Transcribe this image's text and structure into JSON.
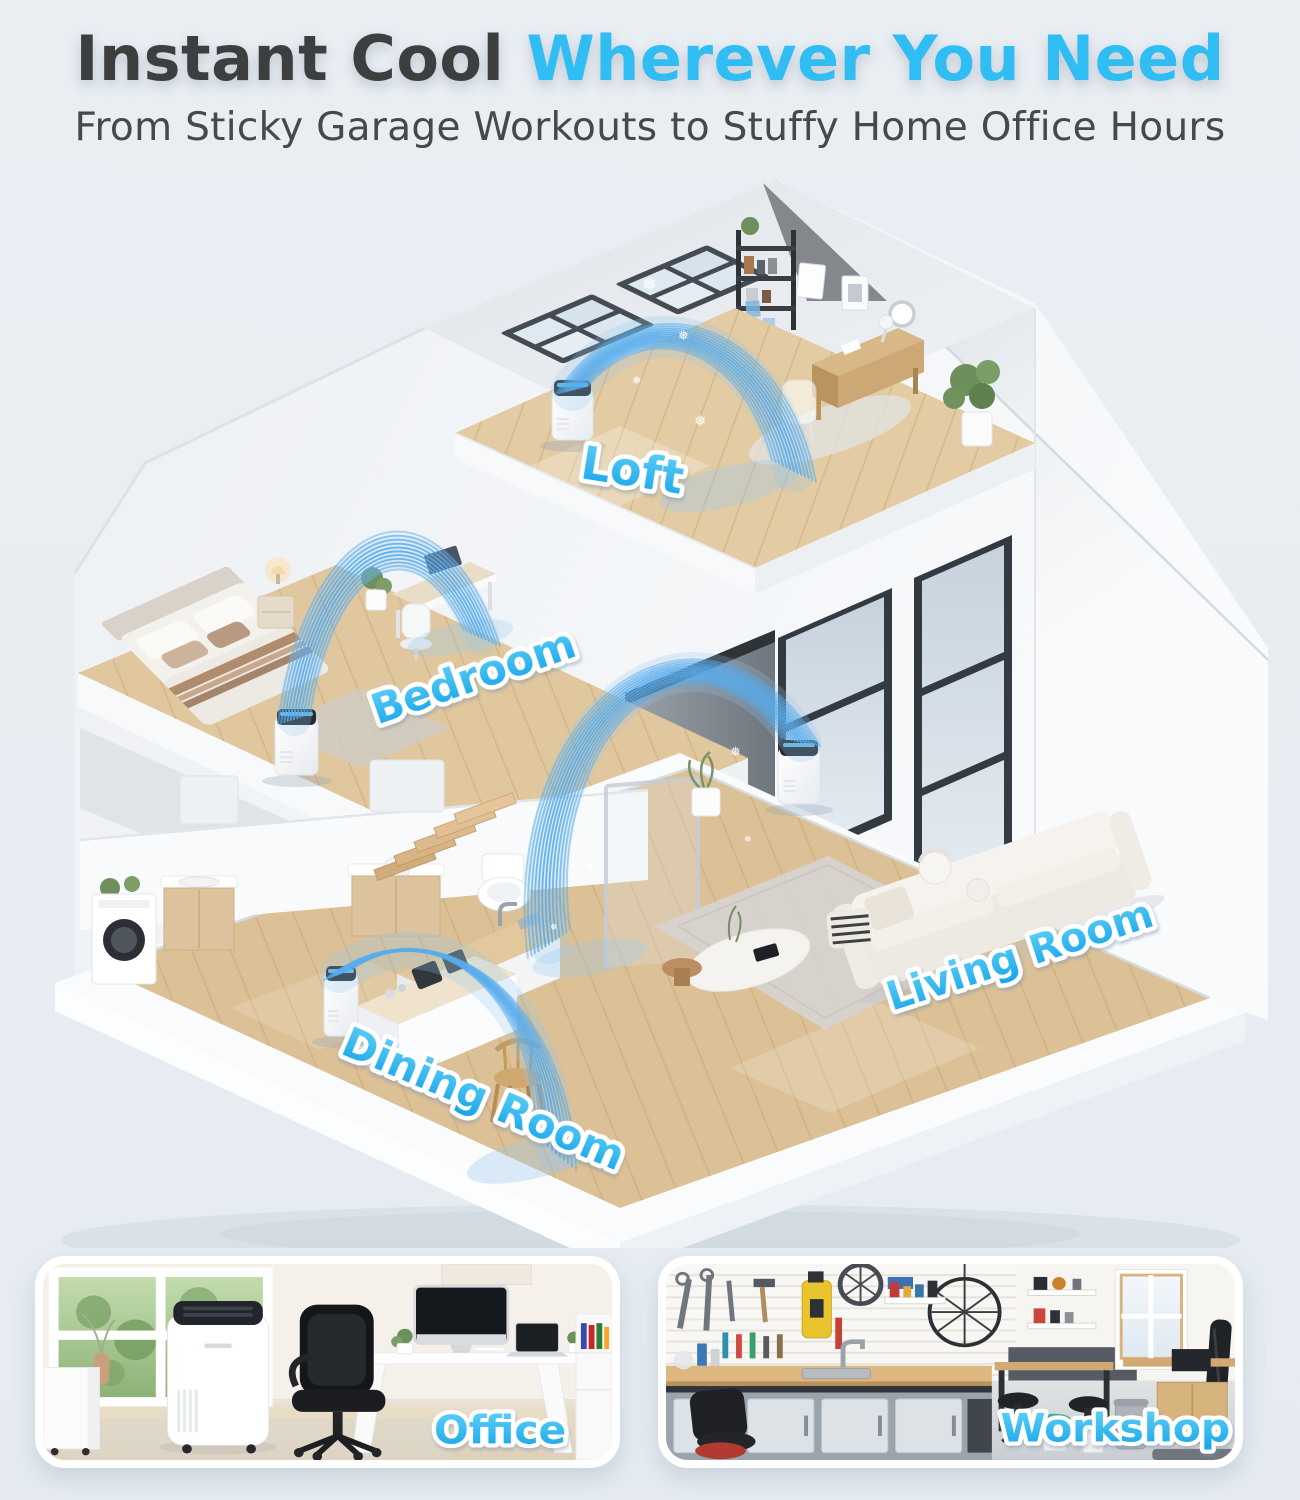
{
  "header": {
    "title": {
      "dark": "Instant Cool",
      "accent": "Wherever You Need"
    },
    "subtitle": "From Sticky Garage Workouts to Stuffy Home Office Hours"
  },
  "house": {
    "rooms": [
      {
        "id": "loft",
        "label": "Loft"
      },
      {
        "id": "bedroom",
        "label": "Bedroom"
      },
      {
        "id": "living-room",
        "label": "Living Room"
      },
      {
        "id": "dining-room",
        "label": "Dining Room"
      }
    ],
    "ac_unit_count": 4,
    "airflow_arc_count": 4
  },
  "photos": [
    {
      "id": "office",
      "label": "Office"
    },
    {
      "id": "workshop",
      "label": "Workshop"
    }
  ],
  "colors": {
    "page_bg": "#e9edf2",
    "title_dark": "#3d3e40",
    "accent_cyan": "#2fbdf4",
    "room_label_cyan_top": "#63d2f7",
    "room_label_cyan_bottom": "#13a3e9",
    "airflow_blue": "#58acec",
    "wood_floor": "#dcc096",
    "wall_white": "#f4f6f8",
    "window_frame": "#353b42"
  }
}
